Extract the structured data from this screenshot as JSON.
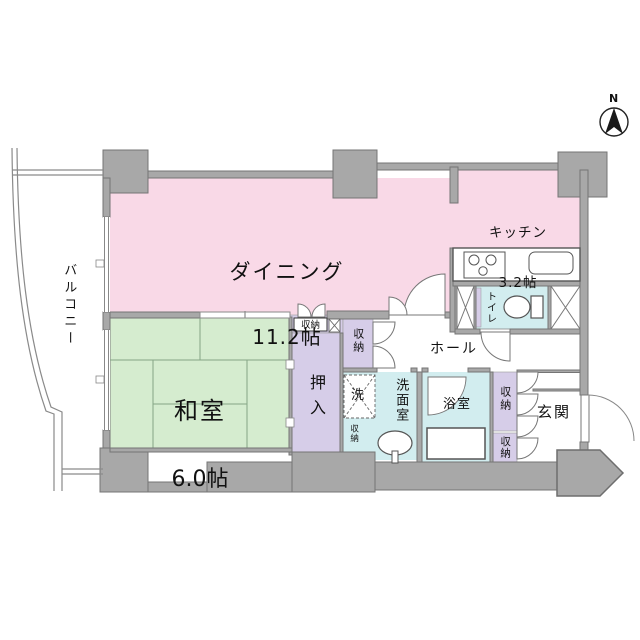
{
  "compass": {
    "north": "N"
  },
  "rooms": {
    "dining": {
      "label": "ダイニング",
      "size": "11.2帖"
    },
    "kitchen": {
      "label": "キッチン",
      "size": "3.2帖"
    },
    "japanese_room": {
      "label": "和室",
      "size": "6.0帖"
    },
    "balcony": {
      "label": "バルコニー"
    },
    "hall": {
      "label": "ホール"
    },
    "entrance": {
      "label": "玄関"
    },
    "toilet": {
      "label": "トイレ"
    },
    "bathroom": {
      "label": "浴室"
    },
    "washroom": {
      "label": "洗面室"
    }
  },
  "closets": {
    "oshiire": "押入",
    "storage": "収納",
    "washer": "洗"
  },
  "colors": {
    "room_pink": "#f9d9e7",
    "room_green": "#d5eccf",
    "room_purple": "#d6cde8",
    "room_blue": "#d2edef",
    "wall_gray": "#a8a8a8"
  }
}
